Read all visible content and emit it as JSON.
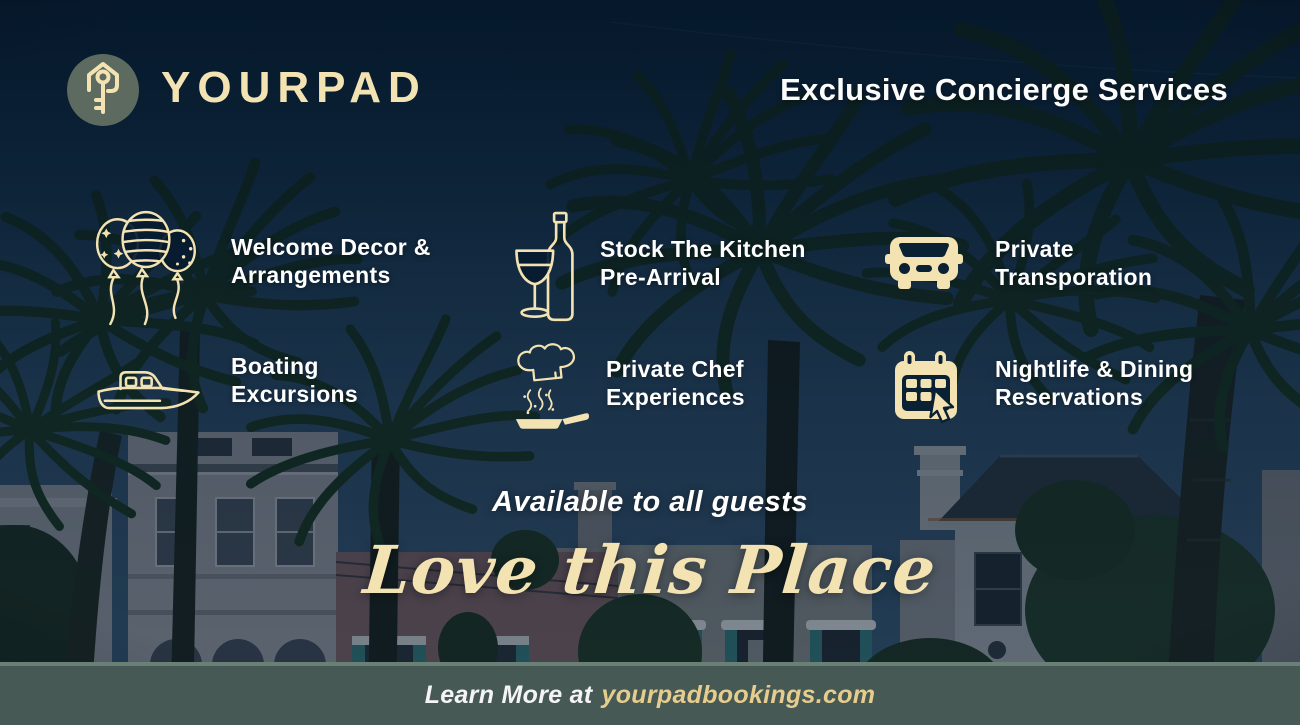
{
  "brand": {
    "name": "YOURPAD",
    "logo_icon": "key-icon"
  },
  "header": {
    "title": "Exclusive Concierge Services"
  },
  "services": [
    {
      "icon": "balloons-icon",
      "line1": "Welcome Decor &",
      "line2": "Arrangements"
    },
    {
      "icon": "wine-bottle-glass-icon",
      "line1": "Stock The Kitchen",
      "line2": "Pre-Arrival"
    },
    {
      "icon": "car-icon",
      "line1": "Private",
      "line2": "Transporation"
    },
    {
      "icon": "boat-icon",
      "line1": "Boating",
      "line2": "Excursions"
    },
    {
      "icon": "chef-hat-pan-icon",
      "line1": "Private Chef",
      "line2": "Experiences"
    },
    {
      "icon": "calendar-cursor-icon",
      "line1": "Nightlife & Dining",
      "line2": "Reservations"
    }
  ],
  "tagline": {
    "subtitle": "Available to all guests",
    "script": "Love this Place"
  },
  "footer": {
    "prefix": "Learn More at",
    "site": "yourpadbookings.com"
  },
  "colors": {
    "cream": "#f3e3b3",
    "gold": "#e6cd8d",
    "navy_sky": "#051d33",
    "footer_green": "#465954",
    "logo_circle": "#5c6a5f",
    "text_white": "#ffffff"
  }
}
